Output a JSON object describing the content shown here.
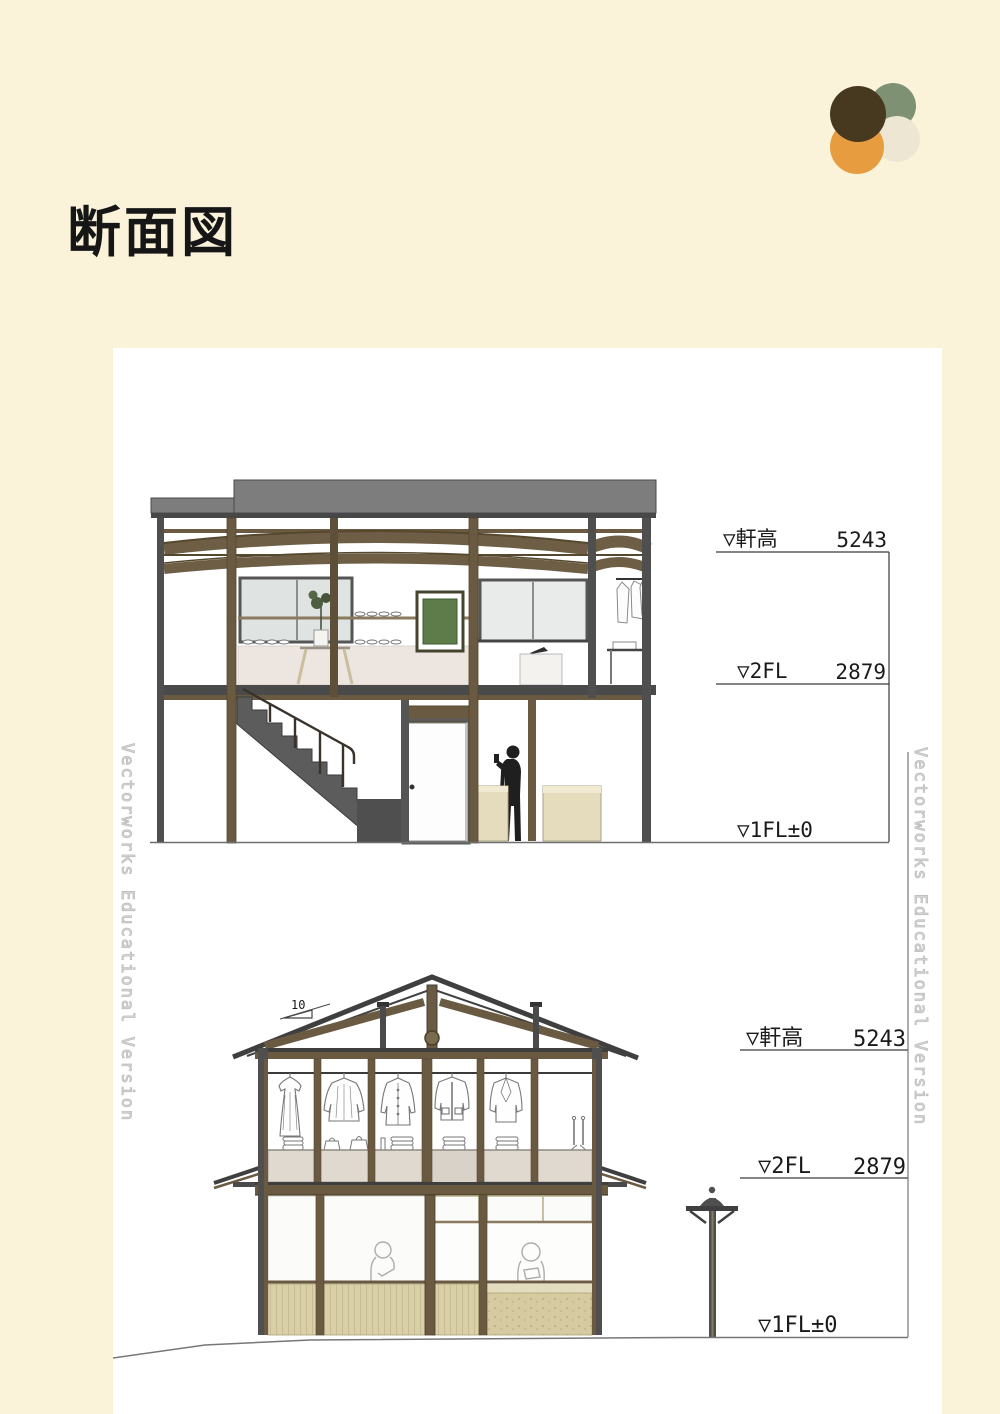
{
  "page": {
    "title": "断面図"
  },
  "logo": {
    "colors": {
      "green": "#7E9173",
      "cream": "#EDE6D2",
      "orange": "#E89C40",
      "brown": "#47391F"
    }
  },
  "watermark": {
    "text": "Vectorworks Educational Version"
  },
  "colors": {
    "background": "#FAF3DA",
    "panel": "#FFFFFF",
    "roof_gray": "#7D7D7D",
    "frame_dark": "#4A4A4A",
    "wood_brown": "#6A5A42",
    "cabinet_beige": "#E4DCBD",
    "wainscot_tan": "#D9D0A8",
    "art_green": "#5E7C4A"
  },
  "drawing_upper": {
    "dims": {
      "eave_label": "▽軒高",
      "eave_value": "5243",
      "fl2_label": "▽2FL",
      "fl2_value": "2879",
      "fl1_label": "▽1FL±0"
    }
  },
  "drawing_lower": {
    "slope_label": "10",
    "dims": {
      "eave_label": "▽軒高",
      "eave_value": "5243",
      "fl2_label": "▽2FL",
      "fl2_value": "2879",
      "fl1_label": "▽1FL±0"
    }
  }
}
